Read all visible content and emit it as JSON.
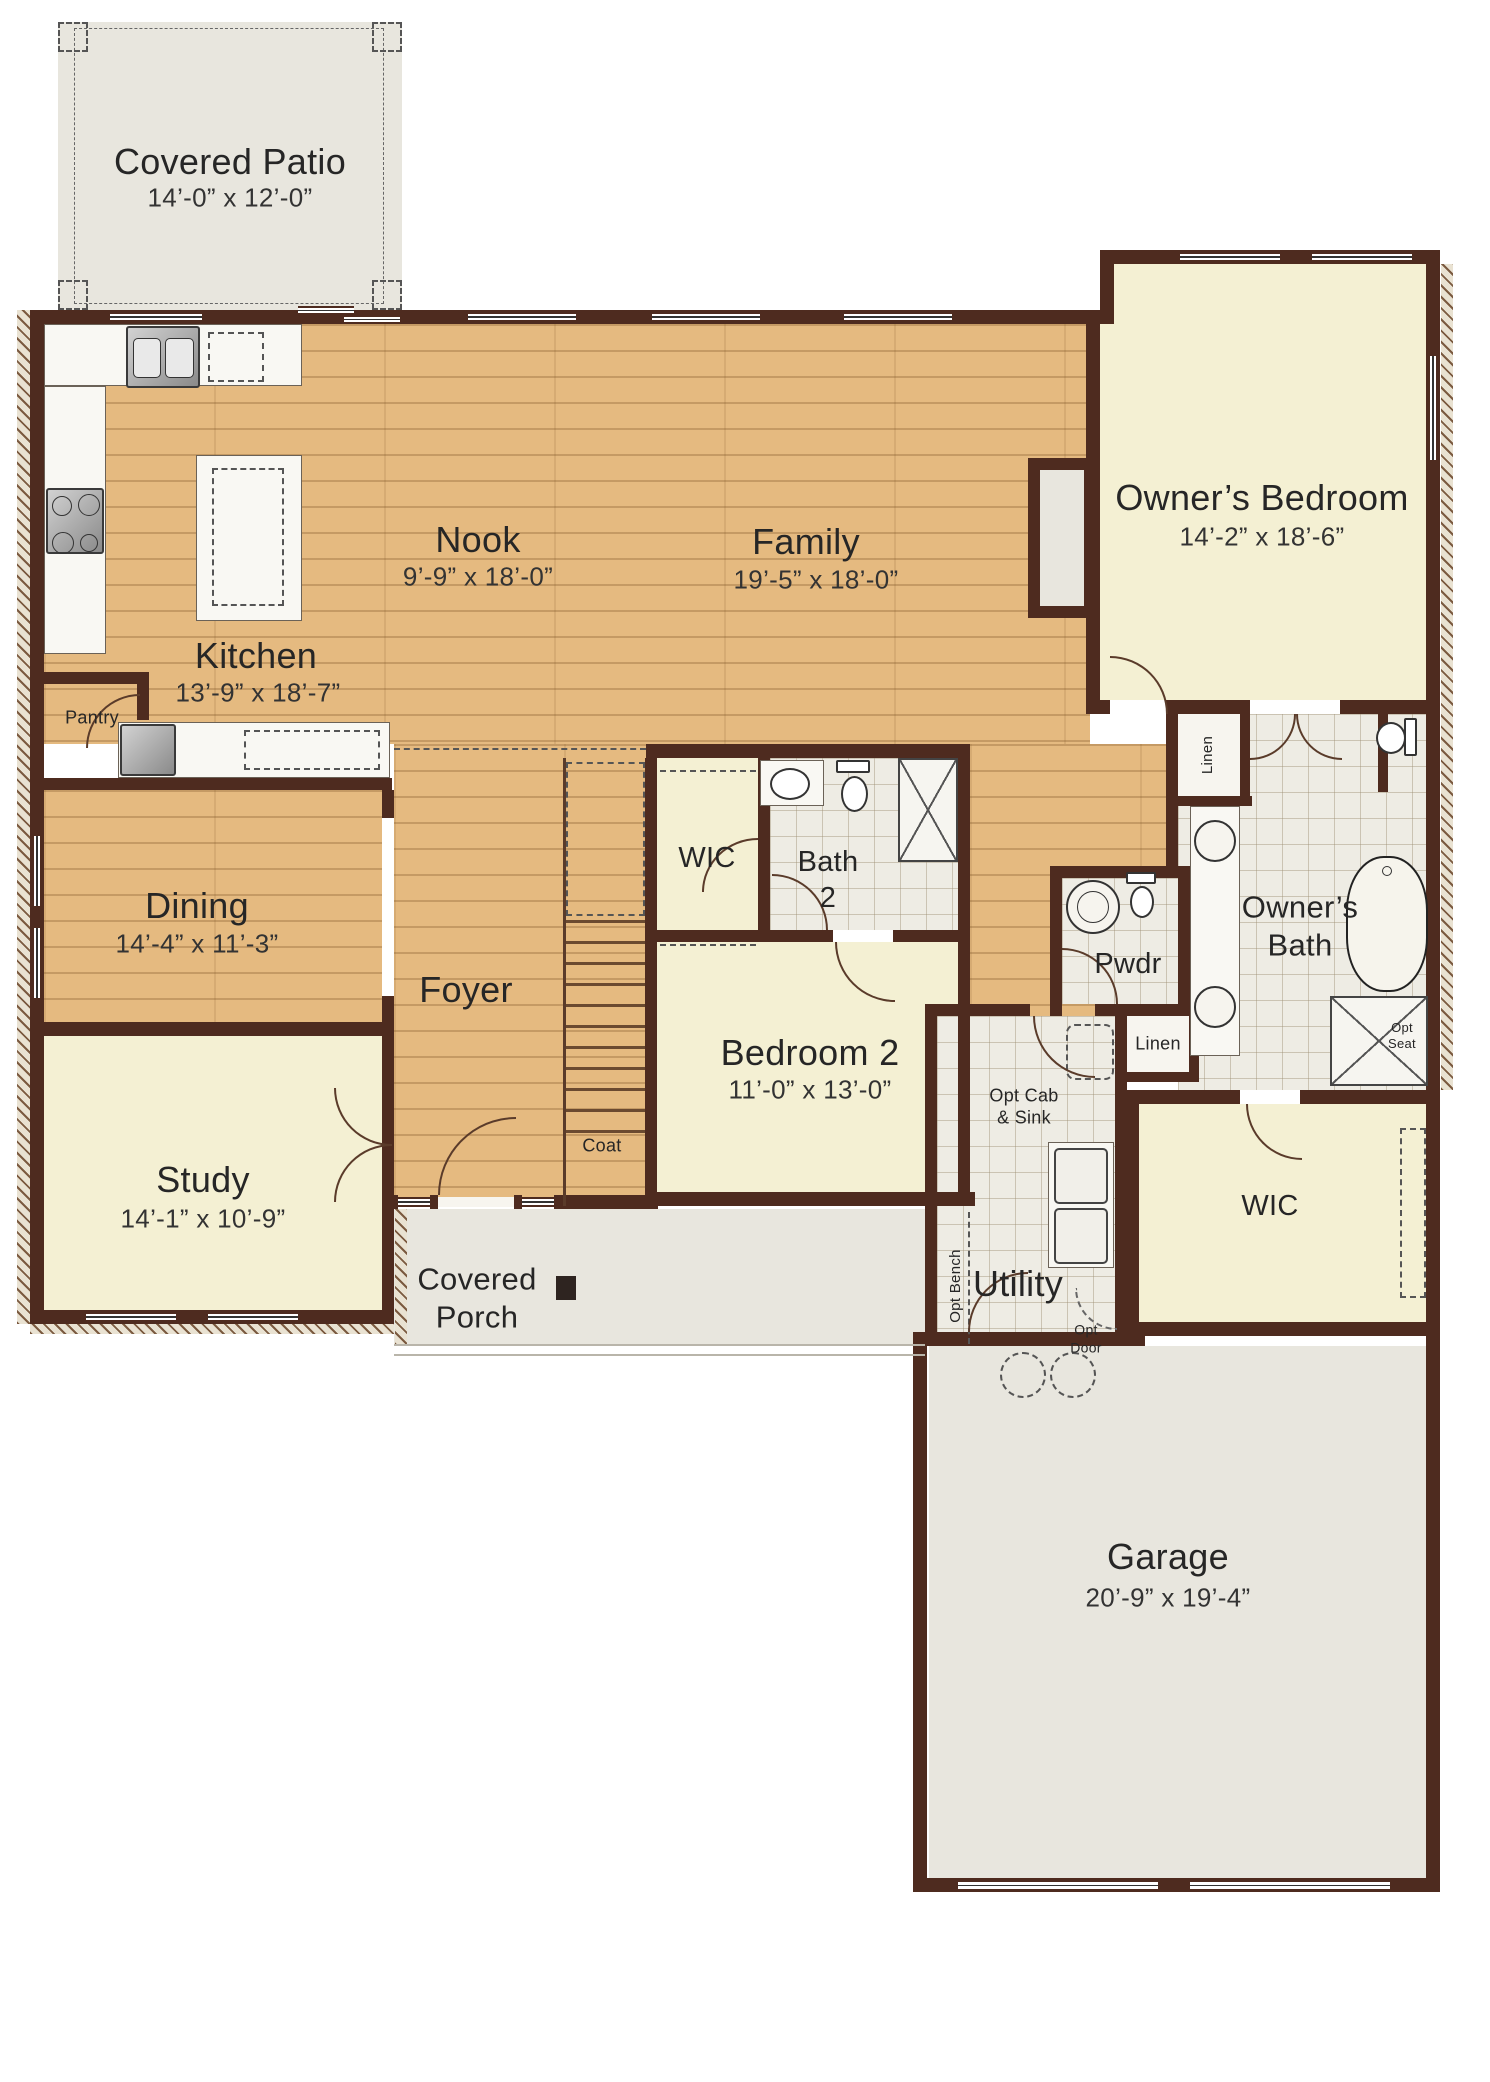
{
  "colors": {
    "wall": "#4e2b1f",
    "wood_floor": "#e5ba80",
    "carpet_cream": "#f4f0d3",
    "tile": "#eeece4",
    "concrete_gray": "#e8e6de",
    "text": "#262626"
  },
  "labels": {
    "covered_patio": "Covered Patio",
    "covered_patio_dims": "14’-0” x 12’-0”",
    "nook": "Nook",
    "nook_dims": "9’-9” x 18’-0”",
    "family": "Family",
    "family_dims": "19’-5” x 18’-0”",
    "owners_bedroom": "Owner’s Bedroom",
    "owners_bedroom_dims": "14’-2” x 18’-6”",
    "kitchen": "Kitchen",
    "kitchen_dims": "13’-9” x 18’-7”",
    "pantry": "Pantry",
    "dining": "Dining",
    "dining_dims": "14’-4” x 11’-3”",
    "wic_hall": "WIC",
    "bath2_line1": "Bath",
    "bath2_line2": "2",
    "foyer": "Foyer",
    "bedroom2": "Bedroom 2",
    "bedroom2_dims": "11’-0” x 13’-0”",
    "pwdr": "Pwdr",
    "owners_bath_line1": "Owner’s",
    "owners_bath_line2": "Bath",
    "opt_seat_line1": "Opt",
    "opt_seat_line2": "Seat",
    "linen_bath": "Linen",
    "linen_hall": "Linen",
    "study": "Study",
    "study_dims": "14’-1” x 10’-9”",
    "coat": "Coat",
    "covered_porch_line1": "Covered",
    "covered_porch_line2": "Porch",
    "utility": "Utility",
    "opt_cab_line1": "Opt Cab",
    "opt_cab_line2": "& Sink",
    "opt_bench": "Opt Bench",
    "opt_door_line1": "Opt",
    "opt_door_line2": "Door",
    "wic_owner": "WIC",
    "garage": "Garage",
    "garage_dims": "20’-9” x 19’-4”"
  }
}
